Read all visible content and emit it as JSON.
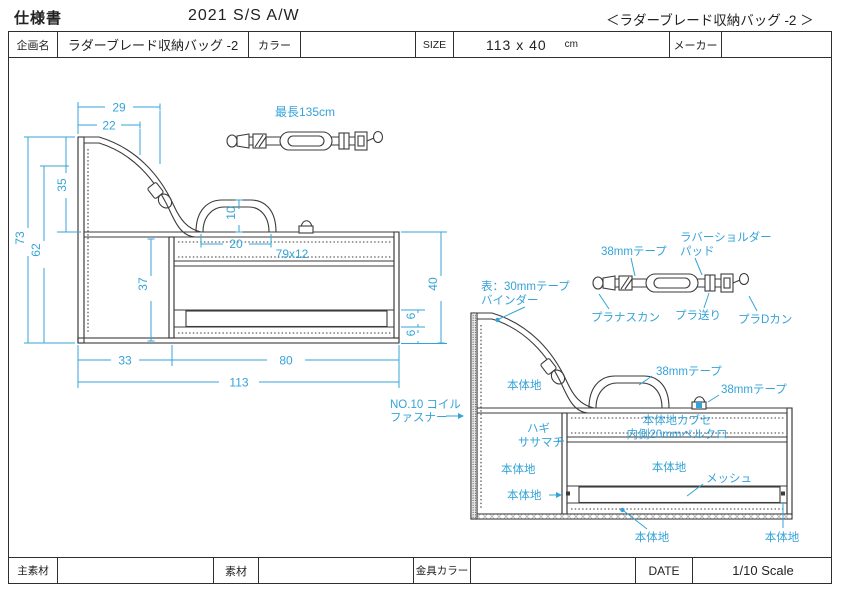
{
  "header": {
    "doc_title": "仕様書",
    "season": "2021 S/S A/W",
    "product_ref": "＜ラダーブレード収納バッグ -2 ＞"
  },
  "info_row": {
    "plan_label": "企画名",
    "plan_value": "ラダーブレード収納バッグ -2",
    "color_label": "カラー",
    "color_value": "",
    "size_label": "SIZE",
    "size_value": "113 x 40",
    "size_unit": "cm",
    "maker_label": "メーカー",
    "maker_value": ""
  },
  "footer_row": {
    "main_material_label": "主素材",
    "main_material_value": "",
    "material_label": "素材",
    "material_value": "",
    "hardware_color_label": "金具カラー",
    "hardware_color_value": "",
    "date_label": "DATE",
    "scale_text": "1/10 Scale"
  },
  "strap_top": {
    "max_length": "最長135cm"
  },
  "left_view": {
    "dims": {
      "top_w1": "29",
      "top_w2": "22",
      "left_h_outer": "73",
      "left_h_mid": "62",
      "left_h_upper": "35",
      "inner_h": "37",
      "handle_h": "10",
      "handle_w": "20",
      "flap_size": "79x12",
      "right_h": "40",
      "mesh_h": "6",
      "bottom_band_h": "6",
      "bottom_w_left": "33",
      "bottom_w_right": "80",
      "total_w": "113"
    }
  },
  "right_view": {
    "labels": {
      "binder_line1": "表：30mmテープ",
      "binder_line2": "バインダー",
      "zipper_line1": "NO.10 コイル",
      "zipper_line2": "ファスナー",
      "body_upper": "本体地",
      "hagi": "ハギ",
      "sasamachi": "ササマチ",
      "body_left": "本体地",
      "body_left_small": "本体地",
      "kabuse_line1": "本体地カブセ",
      "kabuse_line2": "内側20mmベルクロ",
      "body_center": "本体地",
      "mesh": "メッシュ",
      "body_bottom_center": "本体地",
      "body_bottom_right": "本体地",
      "tape_handle": "38mmテープ",
      "tape_dring": "38mmテープ"
    }
  },
  "strap_detail": {
    "labels": {
      "tape": "38mmテープ",
      "pad_line1": "ラバーショルダー",
      "pad_line2": "パッド",
      "nasukan": "プラナスカン",
      "okuri": "プラ送り",
      "dkan": "プラDカン"
    }
  },
  "colors": {
    "accent": "#35a3d8",
    "line": "#3b3b3b"
  }
}
